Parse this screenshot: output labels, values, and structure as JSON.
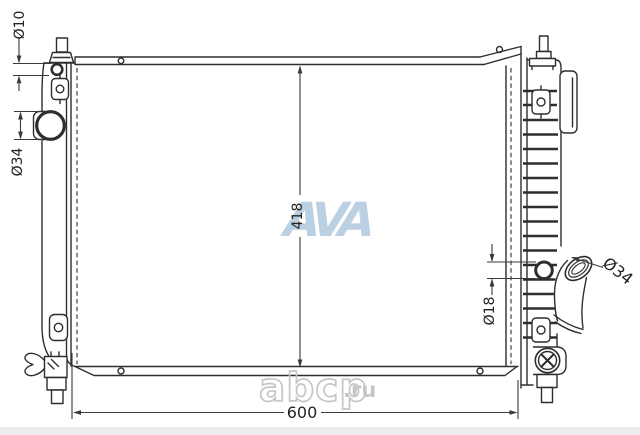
{
  "drawing": {
    "dimensions": {
      "top_port_diameter": "Ø10",
      "left_port_diameter": "Ø34",
      "core_height": "418",
      "core_width": "600",
      "right_port_diameter": "Ø18",
      "hose_diameter": "Ø34"
    },
    "watermarks": {
      "center_logo": "AVA",
      "site_name": "abcp",
      "site_domain": ".ru"
    },
    "colors": {
      "line": "#2e2e2e",
      "dimension_line": "#3a3a3a",
      "watermark_blue": "#b4cbdf",
      "watermark_gray": "#c6c6c6",
      "background": "#ffffff"
    }
  }
}
